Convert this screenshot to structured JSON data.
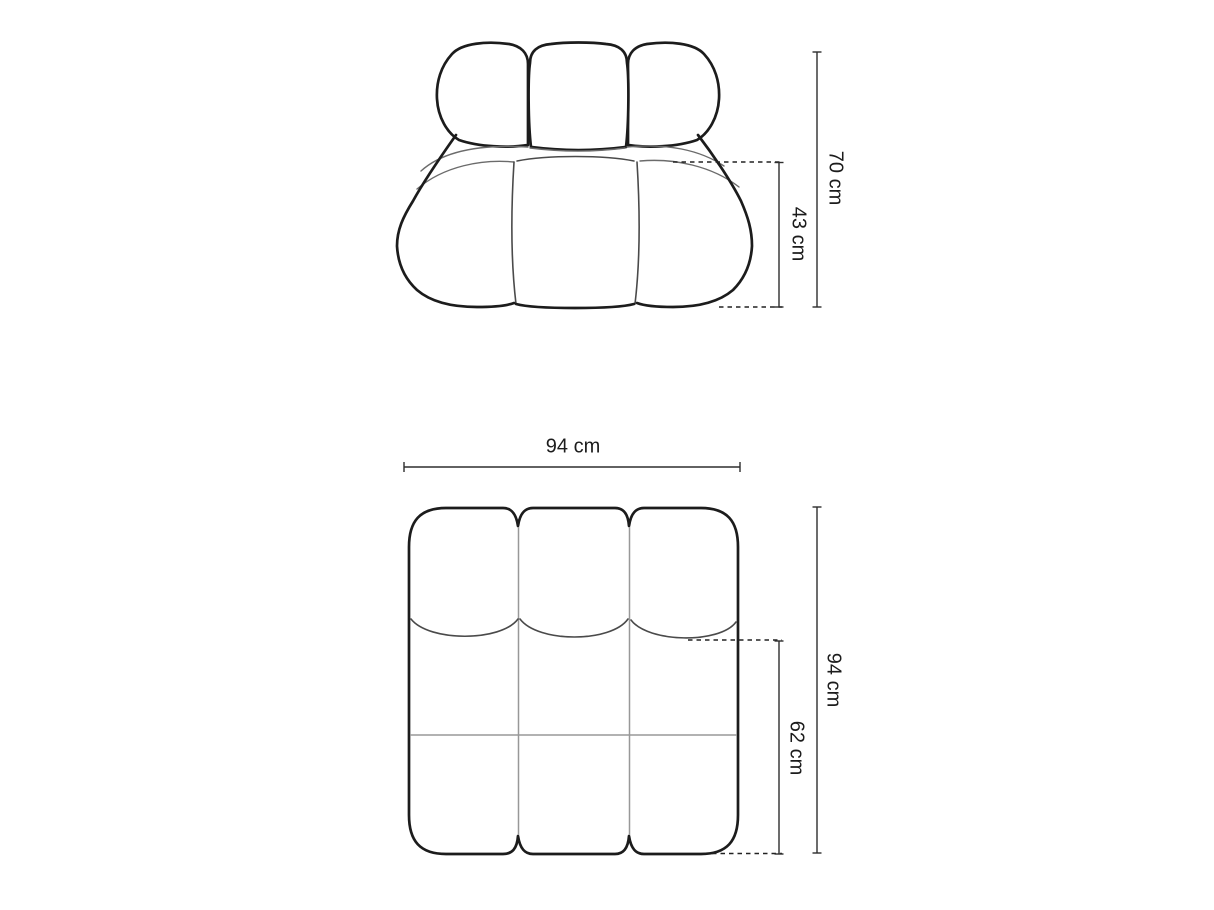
{
  "figure": {
    "front_view": {
      "height_label": "70 cm",
      "seat_height_label": "43 cm"
    },
    "top_view": {
      "width_label": "94 cm",
      "depth_label": "94 cm",
      "seat_depth_label": "62 cm"
    }
  },
  "colors": {
    "background": "#ffffff",
    "outline": "#1c1c1c",
    "seam_light": "#6b6b6b",
    "seam_medium": "#4a4a4a",
    "divider_line": "#989898",
    "dimension_line": "#2e2e2e",
    "label_text": "#1c1c1c"
  }
}
